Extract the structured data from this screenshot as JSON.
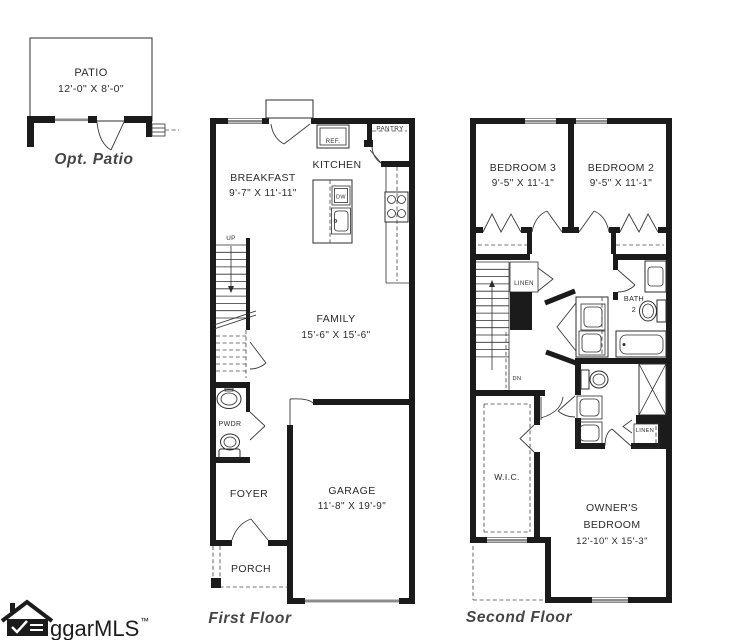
{
  "opt_patio": {
    "room": "PATIO",
    "dims": "12'-0\" X 8'-0\"",
    "caption": "Opt. Patio"
  },
  "first_floor": {
    "caption": "First Floor",
    "breakfast_name": "BREAKFAST",
    "breakfast_dims": "9'-7\" X 11'-11\"",
    "kitchen_name": "KITCHEN",
    "pantry_name": "PANTRY",
    "ref_label": "REF.",
    "dw_label": "DW",
    "up_label": "UP",
    "family_name": "FAMILY",
    "family_dims": "15'-6\" X 15'-6\"",
    "powder_name": "PWDR",
    "foyer_name": "FOYER",
    "garage_name": "GARAGE",
    "garage_dims": "11'-8\" X 19'-9\"",
    "porch_name": "PORCH"
  },
  "second_floor": {
    "caption": "Second Floor",
    "bedroom3_name": "BEDROOM 3",
    "bedroom3_dims": "9'-5\" X 11'-1\"",
    "bedroom2_name": "BEDROOM 2",
    "bedroom2_dims": "9'-5\" X 11'-1\"",
    "linen_upper": "LINEN",
    "bath2_name": "BATH",
    "bath2_number": "2",
    "dn_label": "DN",
    "wic_name": "W.I.C.",
    "linen_lower": "LINEN",
    "owners_line1": "OWNER'S",
    "owners_line2": "BEDROOM",
    "owners_dims": "12'-10\" X 15'-3\""
  },
  "watermark": {
    "brand": "ggarMLS",
    "tm": "™"
  }
}
